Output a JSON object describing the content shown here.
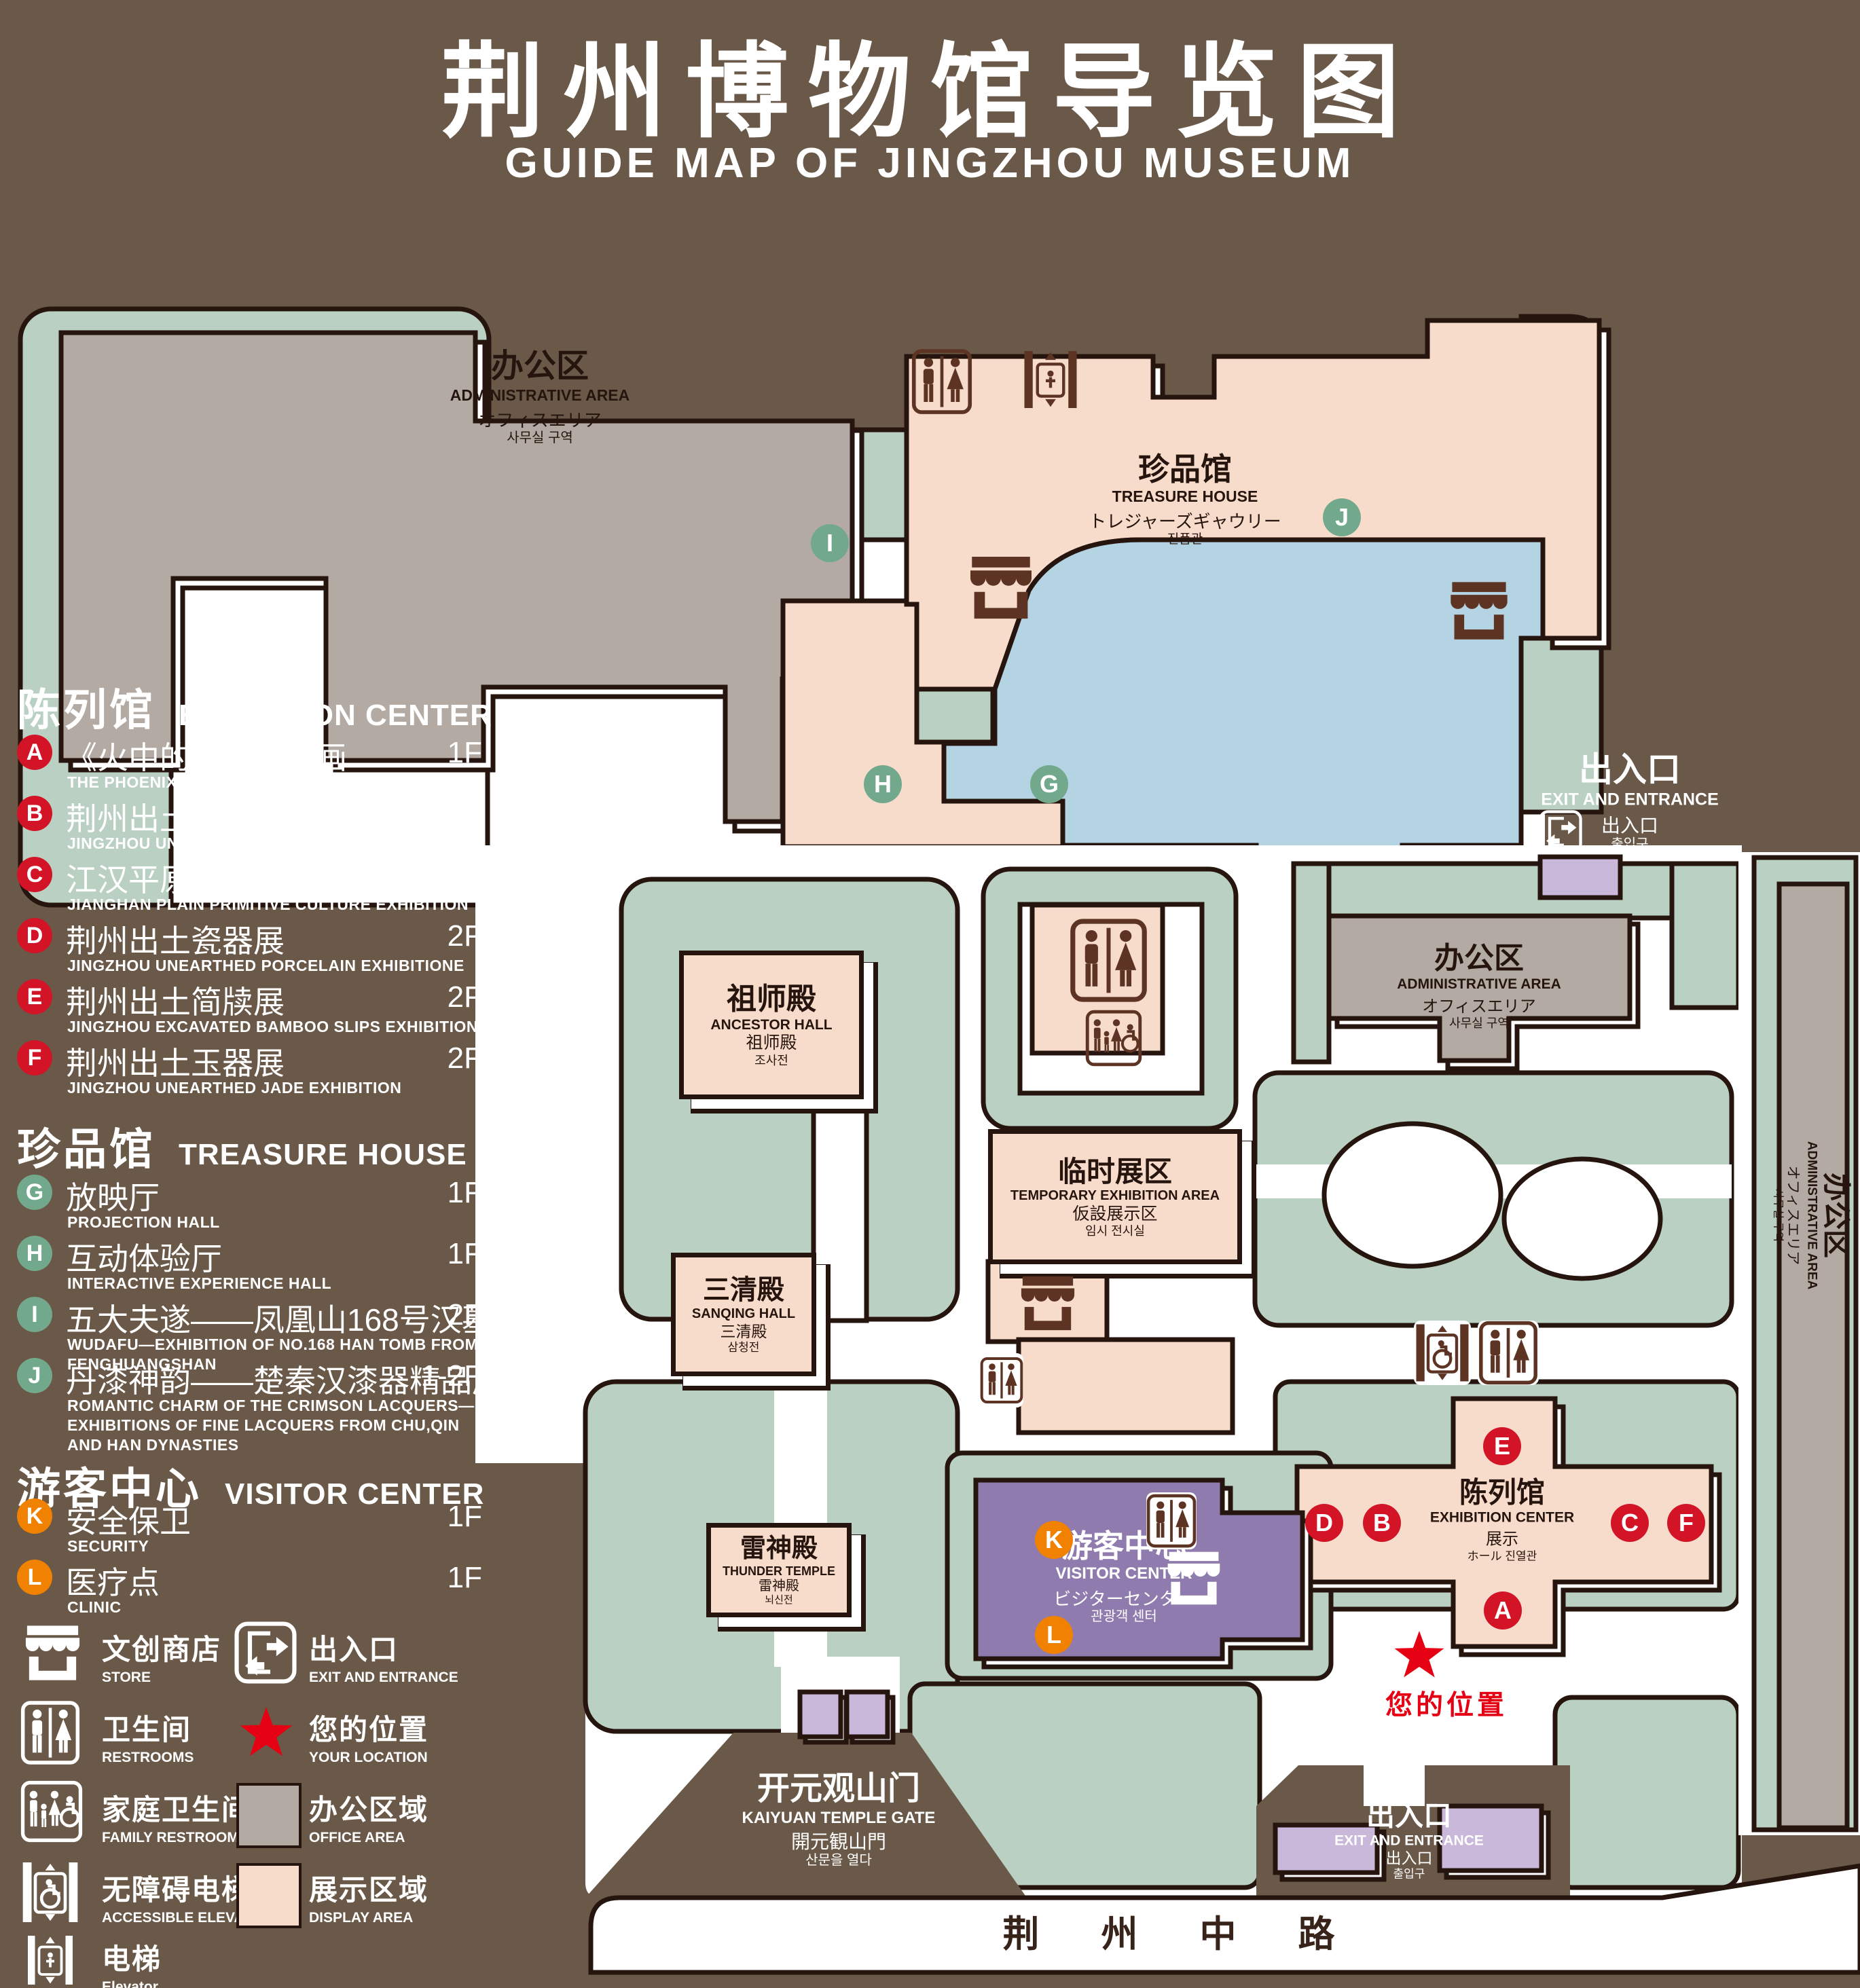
{
  "title": {
    "zh": "荆州博物馆导览图",
    "en": "GUIDE MAP OF JINGZHOU MUSEUM"
  },
  "legend": {
    "sections": [
      {
        "zh": "陈列馆",
        "en": "EXHIBITION CENTER",
        "items": [
          {
            "letter": "A",
            "zh": "《火中的凤凰》壁画",
            "en": "THE PHOENIX IN FIRE \"MURAL PAINTING",
            "floor": "1F"
          },
          {
            "letter": "B",
            "zh": "荆州出土铜器展",
            "en": "JINGZHOU UNEARTHED BRONZE WARE EXHIBITION",
            "floor": "1F"
          },
          {
            "letter": "C",
            "zh": "江汉平原原始文化展",
            "en": "JIANGHAN PLAIN PRIMITIVE CULTURE EXHIBITION",
            "floor": "1F"
          },
          {
            "letter": "D",
            "zh": "荆州出土瓷器展",
            "en": "JINGZHOU UNEARTHED PORCELAIN EXHIBITIONE",
            "floor": "2F"
          },
          {
            "letter": "E",
            "zh": "荆州出土简牍展",
            "en": "JINGZHOU EXCAVATED BAMBOO SLIPS EXHIBITION",
            "floor": "2F"
          },
          {
            "letter": "F",
            "zh": "荆州出土玉器展",
            "en": "JINGZHOU UNEARTHED JADE EXHIBITION",
            "floor": "2F"
          }
        ]
      },
      {
        "zh": "珍品馆",
        "en": "TREASURE HOUSE",
        "items": [
          {
            "letter": "G",
            "zh": "放映厅",
            "en": "PROJECTION HALL",
            "floor": "1F"
          },
          {
            "letter": "H",
            "zh": "互动体验厅",
            "en": "INTERACTIVE EXPERIENCE HALL",
            "floor": "1F"
          },
          {
            "letter": "I",
            "zh": "五大夫遂——凤凰山168号汉墓展",
            "en": "WUDAFU—EXHIBITION OF NO.168 HAN TOMB FROM FENGHUANGSHAN",
            "floor": "2F"
          },
          {
            "letter": "J",
            "zh": "丹漆神韵——楚秦汉漆器精品展",
            "en": "ROMANTIC CHARM OF THE CRIMSON LACQUERS—EXHIBITIONS OF FINE LACQUERS FROM CHU,QIN AND HAN DYNASTIES",
            "floor": "1-2F"
          }
        ]
      },
      {
        "zh": "游客中心",
        "en": "VISITOR CENTER",
        "items": [
          {
            "letter": "K",
            "zh": "安全保卫",
            "en": "SECURITY",
            "floor": "1F"
          },
          {
            "letter": "L",
            "zh": "医疗点",
            "en": "CLINIC",
            "floor": "1F"
          }
        ]
      }
    ],
    "symbols": [
      {
        "zh": "文创商店",
        "en": "STORE"
      },
      {
        "zh": "出入口",
        "en": "EXIT AND ENTRANCE"
      },
      {
        "zh": "卫生间",
        "en": "RESTROOMS"
      },
      {
        "zh": "您的位置",
        "en": "YOUR LOCATION"
      },
      {
        "zh": "家庭卫生间",
        "en": "FAMILY RESTROOMS"
      },
      {
        "zh": "办公区域",
        "en": "OFFICE AREA"
      },
      {
        "zh": "无障碍电梯",
        "en": "ACCESSIBLE ELEVATOR"
      },
      {
        "zh": "展示区域",
        "en": "DISPLAY AREA"
      },
      {
        "zh": "电梯",
        "en": "Elevator"
      }
    ]
  },
  "map": {
    "labels": {
      "admin_tl": {
        "l1": "办公区",
        "l2": "ADMINISTRATIVE AREA",
        "l3": "オフィスエリア",
        "l4": "사무실 구역"
      },
      "treasure": {
        "l1": "珍品馆",
        "l2": "TREASURE HOUSE",
        "l3": "トレジャーズギャウリー",
        "l4": "진품관"
      },
      "ancestor": {
        "l1": "祖师殿",
        "l2": "ANCESTOR HALL",
        "l3": "祖师殿",
        "l4": "조사전"
      },
      "temp": {
        "l1": "临时展区",
        "l2": "TEMPORARY EXHIBITION AREA",
        "l3": "仮設展示区",
        "l4": "임시 전시실"
      },
      "sanqing": {
        "l1": "三清殿",
        "l2": "SANQING HALL",
        "l3": "三清殿",
        "l4": "삼청전"
      },
      "office_mid": {
        "l1": "办公区",
        "l2": "ADMINISTRATIVE AREA",
        "l3": "オフィスエリア",
        "l4": "사무실 구역"
      },
      "office_right": {
        "l1": "办公区",
        "l2": "ADMINISTRATIVE AREA",
        "l3": "オフィスエリア",
        "l4": "사무실 구역"
      },
      "thunder": {
        "l1": "雷神殿",
        "l2": "THUNDER TEMPLE",
        "l3": "雷神殿",
        "l4": "뇌신전"
      },
      "exhibition": {
        "l1": "陈列馆",
        "l2": "EXHIBITION CENTER",
        "l3": "展示",
        "l4": "ホール 진열관"
      },
      "visitor": {
        "l1": "游客中心",
        "l2": "VISITOR CENTER",
        "l3": "ビジターセンター",
        "l4": "관광객 센터"
      },
      "gate": {
        "l1": "开元观山门",
        "l2": "KAIYUAN TEMPLE GATE",
        "l3": "開元観山門",
        "l4": "산문을 열다"
      },
      "exit_tr": {
        "l1": "出入口",
        "l2": "EXIT AND ENTRANCE",
        "l3": "出入口",
        "l4": "출입구"
      },
      "exit_bottom": {
        "l1": "出入口",
        "l2": "EXIT AND ENTRANCE",
        "l3": "出入口",
        "l4": "출입구"
      },
      "road": "荆 州 中 路",
      "your_location": "您的位置"
    },
    "markers": {
      "a": "A",
      "b": "B",
      "c": "C",
      "d": "D",
      "e": "E",
      "f": "F",
      "g": "G",
      "h": "H",
      "i": "I",
      "j": "J",
      "k": "K",
      "l": "L"
    },
    "colors": {
      "background": "#6a5948",
      "lawn": "#b9d0c2",
      "display_area": "#f8dccb",
      "office_area": "#b3aaa4",
      "pond": "#b5d4e3",
      "visitor_center": "#8f7bae",
      "entrance_buildings": "#cab8da",
      "marker_red": "#d31426",
      "marker_green": "#72a98c",
      "marker_orange": "#f18101",
      "icon_brown": "#5d3423",
      "location_red": "#e60013"
    }
  }
}
